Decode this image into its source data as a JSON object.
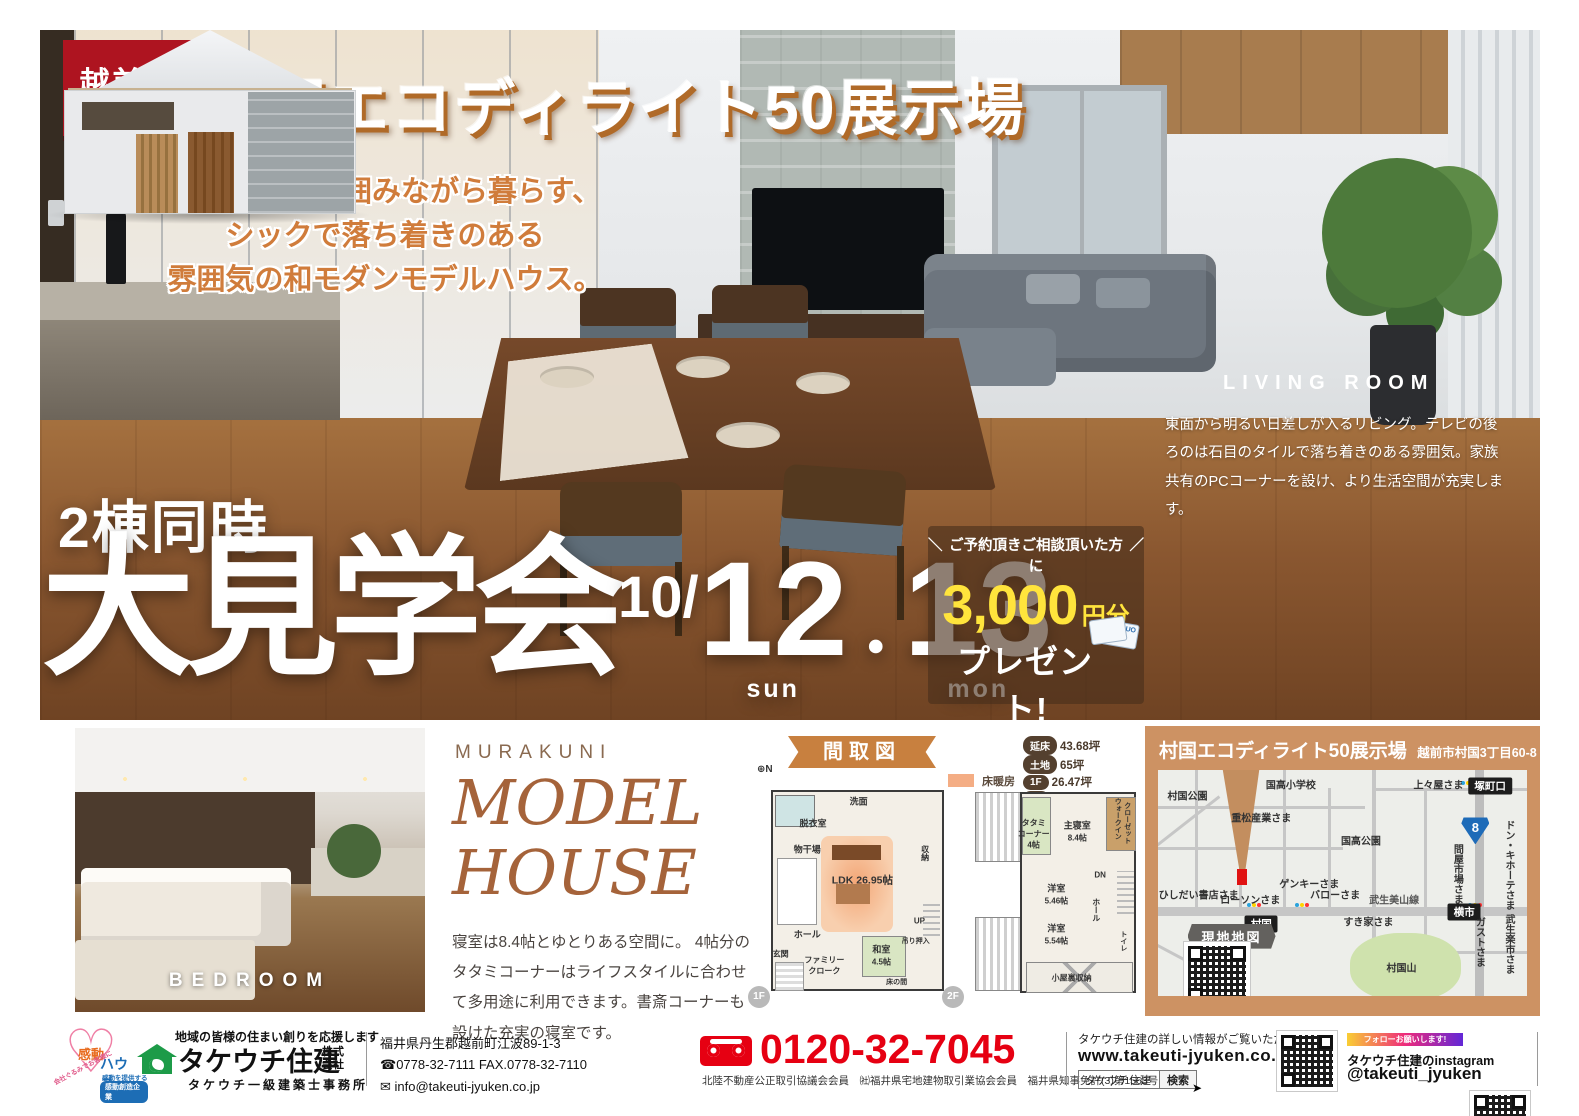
{
  "colors": {
    "accent_orange": "#c8803f",
    "badge_red": "#ae1420",
    "brand_brown": "#a5633a",
    "phone_red": "#e60012",
    "coupon_yellow": "#ffe43c",
    "map_bg": "#cd9263"
  },
  "city_badge": {
    "name": "越前市",
    "romaji": "ECHIZEN"
  },
  "title": "村国エコディライト50展示場",
  "tagline": {
    "line1": "憧れの中庭を囲みながら暮らす、",
    "line2": "シックで落ち着きのある",
    "line3": "雰囲気の和モダンモデルハウス。"
  },
  "living_room": {
    "heading": "LIVING ROOM",
    "body": "東面から明るい日差しが入るリビング。テレビの後ろのは石目のタイルで落ち着きのある雰囲気。家族共有のPCコーナーを設け、より生活空間が充実します。"
  },
  "event": {
    "lead": "2棟同時",
    "title": "大見学会",
    "month": "10/",
    "day1": "12",
    "dot": "・",
    "day2": "13",
    "dow1": "sun",
    "dow2": "mon"
  },
  "coupon": {
    "slash_l": "＼",
    "condition": "ご予約頂きご相談頂いた方に",
    "slash_r": "／",
    "amount": "3,000",
    "unit": "円分",
    "present": "プレゼント!",
    "note1": "ご予約はホームページ又は",
    "note2": "090-9131-1709(竹内)まで",
    "card": "QUO"
  },
  "bedroom_caption": "BEDROOM",
  "model_house": {
    "brand": "MURAKUNI",
    "title1": "MODEL",
    "title2": "HOUSE",
    "description": "寝室は8.4帖とゆとりある空間に。 4帖分のタタミコーナーはライフスタイルに合わせて多用途に利用できます。書斎コーナーも設けた充実の寝室です。"
  },
  "floor_plan": {
    "ribbon": "間取図",
    "legend_heating": "床暖房",
    "stats": [
      {
        "label": "延床",
        "value": "43.68坪"
      },
      {
        "label": "土地",
        "value": "65坪"
      },
      {
        "label": "1F",
        "value": "26.47坪"
      },
      {
        "label": "2F",
        "value": "17.20坪"
      },
      {
        "label": "小屋裏",
        "value": "3.57坪"
      }
    ],
    "compass": "N",
    "f1_badge": "1F",
    "f2_badge": "2F",
    "f1_rooms": [
      {
        "text": "洗面",
        "x": 54,
        "y": 6,
        "cls": "r9"
      },
      {
        "text": "脱衣室",
        "x": 30,
        "y": 16,
        "cls": "r9"
      },
      {
        "text": "物干場",
        "x": 27,
        "y": 28,
        "cls": "r9"
      },
      {
        "text": "LDK 26.95帖",
        "x": 56,
        "y": 42,
        "cls": "r11"
      },
      {
        "text": "収納",
        "x": 89,
        "y": 30,
        "cls": "r8 v"
      },
      {
        "text": "UP",
        "x": 86,
        "y": 61,
        "cls": "r8"
      },
      {
        "text": "ホール",
        "x": 27,
        "y": 67,
        "cls": "r9"
      },
      {
        "text": "玄関",
        "x": 13,
        "y": 76,
        "cls": "r8"
      },
      {
        "text": "ファミリー",
        "x": 36,
        "y": 79,
        "cls": "r8"
      },
      {
        "text": "クローク",
        "x": 36,
        "y": 84,
        "cls": "r8"
      },
      {
        "text": "和室",
        "x": 66,
        "y": 74,
        "cls": "r9"
      },
      {
        "text": "4.5帖",
        "x": 66,
        "y": 80,
        "cls": "r8"
      },
      {
        "text": "吊り押入",
        "x": 84,
        "y": 70,
        "cls": "r7"
      },
      {
        "text": "床の間",
        "x": 74,
        "y": 89,
        "cls": "r7"
      }
    ],
    "f2_rooms": [
      {
        "text": "タタミ",
        "x": 44,
        "y": 16,
        "cls": "r8"
      },
      {
        "text": "コーナー",
        "x": 44,
        "y": 21,
        "cls": "r8"
      },
      {
        "text": "4帖",
        "x": 44,
        "y": 26,
        "cls": "r8"
      },
      {
        "text": "主寝室",
        "x": 67,
        "y": 17,
        "cls": "r9"
      },
      {
        "text": "8.4帖",
        "x": 67,
        "y": 23,
        "cls": "r8"
      },
      {
        "text": "ウォークイン",
        "x": 88,
        "y": 14,
        "cls": "r7 v"
      },
      {
        "text": "クローゼット",
        "x": 93,
        "y": 16,
        "cls": "r7 v"
      },
      {
        "text": "DN",
        "x": 79,
        "y": 40,
        "cls": "r8"
      },
      {
        "text": "洋室",
        "x": 56,
        "y": 46,
        "cls": "r9"
      },
      {
        "text": "5.46帖",
        "x": 56,
        "y": 52,
        "cls": "r8"
      },
      {
        "text": "ホール",
        "x": 77,
        "y": 56,
        "cls": "r8 v"
      },
      {
        "text": "洋室",
        "x": 56,
        "y": 64,
        "cls": "r9"
      },
      {
        "text": "5.54帖",
        "x": 56,
        "y": 70,
        "cls": "r8"
      },
      {
        "text": "トイレ",
        "x": 91,
        "y": 70,
        "cls": "r7 v"
      },
      {
        "text": "小屋裏収納",
        "x": 64,
        "y": 87,
        "cls": "r8"
      }
    ]
  },
  "map": {
    "header_title": "村国エコディライト50展示場",
    "header_address": "越前市村国3丁目60-8",
    "locator_badge": "現地地図",
    "route_number": "8",
    "labels": [
      {
        "text": "国高小学校",
        "x": 36,
        "y": 6
      },
      {
        "text": "村国公園",
        "x": 8,
        "y": 11
      },
      {
        "text": "上々屋さま",
        "x": 76,
        "y": 6
      },
      {
        "text": "塚町口",
        "x": 90,
        "y": 7,
        "cls": "badge"
      },
      {
        "text": "重松産業さま",
        "x": 28,
        "y": 21
      },
      {
        "text": "国高公園",
        "x": 55,
        "y": 31
      },
      {
        "text": "ドン・キホーテさま",
        "x": 95,
        "y": 42,
        "cls": "v"
      },
      {
        "text": "問屋市場さま",
        "x": 81,
        "y": 46,
        "cls": "v"
      },
      {
        "text": "ひしだい書店さま",
        "x": 11,
        "y": 55
      },
      {
        "text": "ローソンさま",
        "x": 25,
        "y": 57
      },
      {
        "text": "ゲンキーさま",
        "x": 41,
        "y": 50
      },
      {
        "text": "バローさま",
        "x": 48,
        "y": 55
      },
      {
        "text": "武生美山線",
        "x": 64,
        "y": 57,
        "cls": "roadname"
      },
      {
        "text": "村国",
        "x": 28,
        "y": 68,
        "cls": "badge"
      },
      {
        "text": "横市",
        "x": 83,
        "y": 63,
        "cls": "badge"
      },
      {
        "text": "すき家さま",
        "x": 57,
        "y": 67
      },
      {
        "text": "ガストさま",
        "x": 87,
        "y": 76,
        "cls": "v"
      },
      {
        "text": "武生楽市さま",
        "x": 95,
        "y": 77,
        "cls": "v"
      },
      {
        "text": "村国山",
        "x": 66,
        "y": 87
      }
    ]
  },
  "footer": {
    "kando": {
      "kanji": "感動",
      "house": "ハウス。",
      "provide": "感動を提供する",
      "company_badge": "感動創造企業",
      "curve": "会社ぐるみでお客様に"
    },
    "company": {
      "tagline": "地域の皆様の住まい創りを応援します",
      "name": "タケウチ住建",
      "suffix1": "株式",
      "suffix2": "会社",
      "office": "タケウチ一級建築士事務所"
    },
    "contact": {
      "address": "福井県丹生郡越前町江波89-1-3",
      "tel": "☎0778-32-7111  FAX.0778-32-7110",
      "email": "✉ info@takeuti-jyuken.co.jp"
    },
    "phone": {
      "number": "0120-32-7045",
      "memberships": "北陸不動産公正取引協議会会員　㈳福井県宅地建物取引業協会会員　福井県知事免許(3)第1563号"
    },
    "web": {
      "note": "タケウチ住建の詳しい情報がご覧いただけます。",
      "url": "www.takeuti-jyuken.co.jp",
      "search_word": "タケウチ住建",
      "search_button": "検索"
    },
    "instagram": {
      "banner": "フォローお願いします!",
      "line1": "タケウチ住建のinstagram",
      "handle": "@takeuti_jyuken"
    }
  }
}
